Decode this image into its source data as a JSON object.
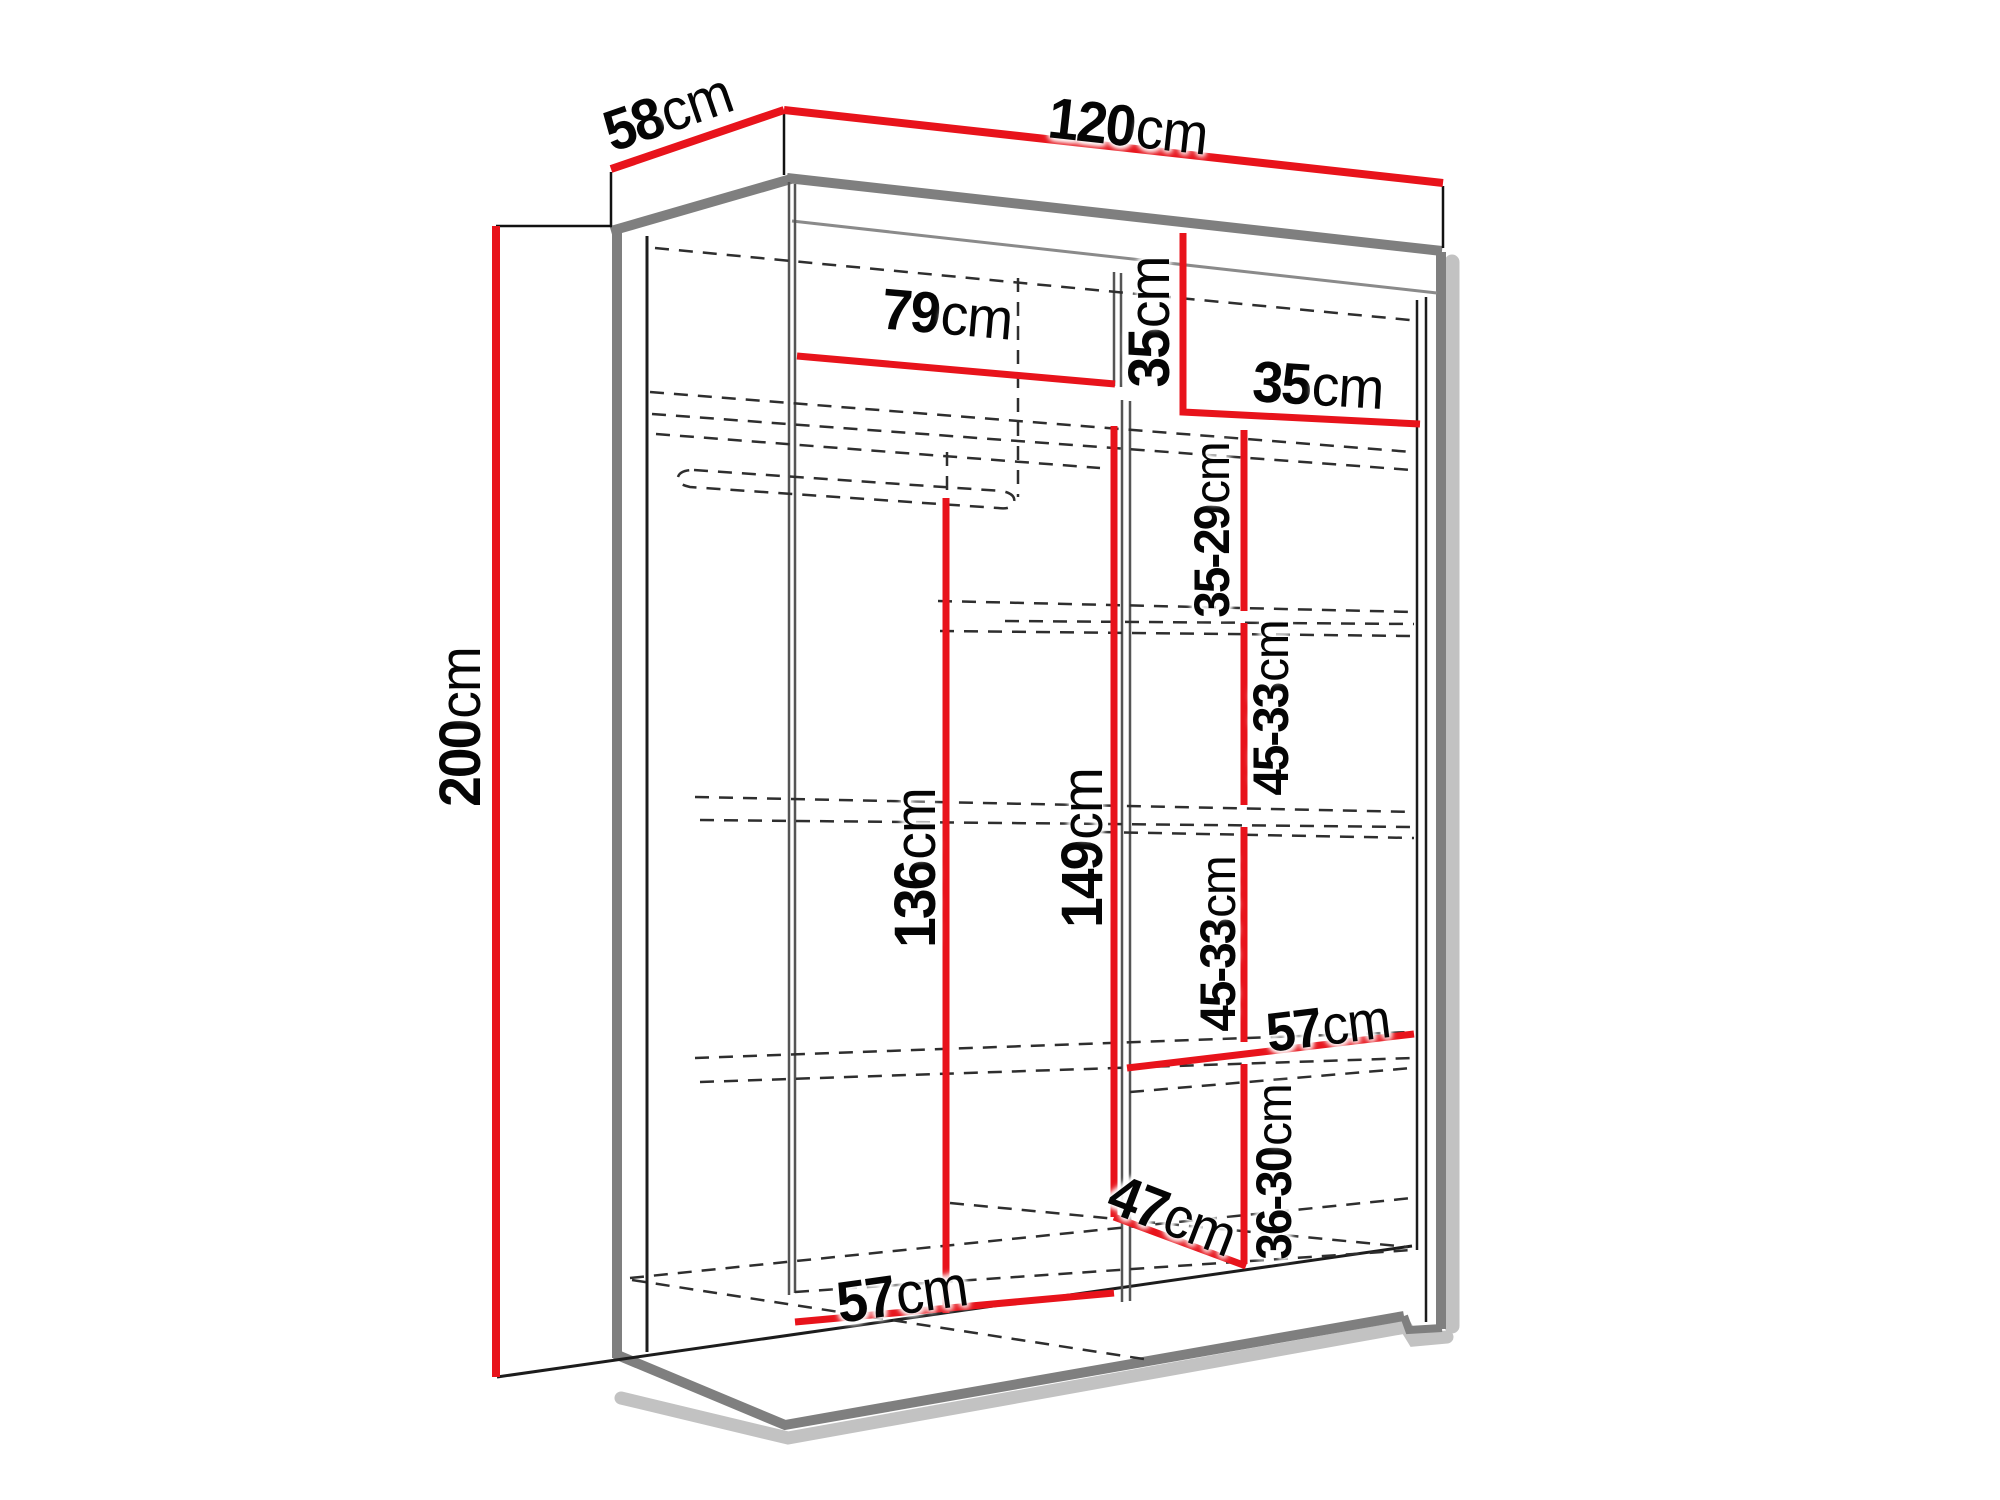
{
  "diagram": {
    "title": "Sliding wardrobe interior dimensions diagram",
    "colors": {
      "dimension_line": "#e8131b",
      "structure_edge": "#7f7f7f",
      "outline": "#1c1c1c",
      "shadow": "#c2c2c2",
      "background": "#ffffff"
    },
    "dimensions": {
      "depth": {
        "value": "58",
        "unit": "cm"
      },
      "width": {
        "value": "120",
        "unit": "cm"
      },
      "height": {
        "value": "200",
        "unit": "cm"
      },
      "top_section_width": {
        "value": "79",
        "unit": "cm"
      },
      "top_cubby_height": {
        "value": "35",
        "unit": "cm"
      },
      "top_cubby_width": {
        "value": "35",
        "unit": "cm"
      },
      "shelf_gap_top": {
        "value": "35-29",
        "unit": "cm"
      },
      "shelf_gap_upper": {
        "value": "45-33",
        "unit": "cm"
      },
      "shelf_gap_lower": {
        "value": "45-33",
        "unit": "cm"
      },
      "shelf_gap_bottom": {
        "value": "36-30",
        "unit": "cm"
      },
      "shelf_width": {
        "value": "57",
        "unit": "cm"
      },
      "hanging_height": {
        "value": "136",
        "unit": "cm"
      },
      "interior_height": {
        "value": "149",
        "unit": "cm"
      },
      "bottom_diagonal": {
        "value": "47",
        "unit": "cm"
      },
      "bottom_width": {
        "value": "57",
        "unit": "cm"
      }
    }
  }
}
